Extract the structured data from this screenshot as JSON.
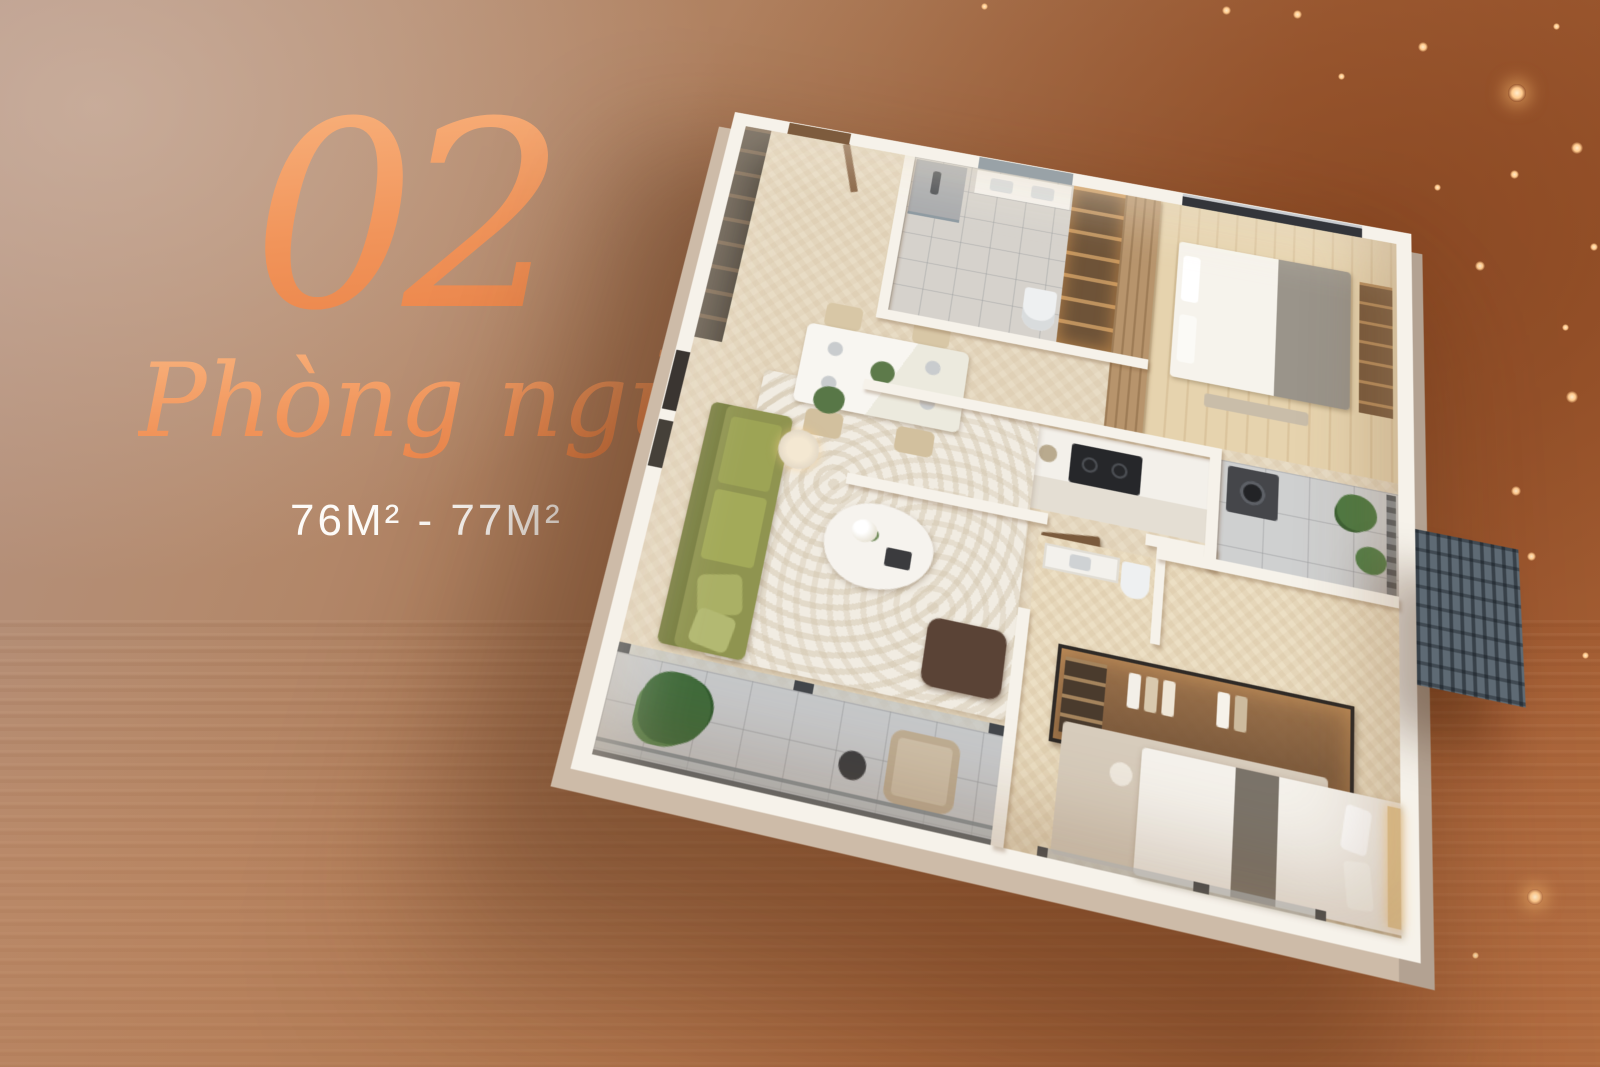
{
  "hero": {
    "unit_number": "02",
    "unit_label": "Phòng ngủ",
    "area_range": "76M² - 77M²"
  },
  "palette": {
    "accent_orange_light": "#F8B27D",
    "accent_orange": "#F2955B",
    "accent_orange_deep": "#EA8145",
    "area_text": "#FDFBF8",
    "bg_taupe": "#B49382",
    "bg_copper": "#A35D33",
    "bg_copper_light": "#BE7D52",
    "wall_white": "#F6F2EA",
    "floor_beige": "#E8DCC5",
    "sparkle_gold": "#FFCA8D",
    "sofa_olive": "#8F9450",
    "closet_bronze": "#7A5437"
  },
  "floorplan": {
    "type": "3d-isometric-cutaway-render",
    "bedrooms_count": 2,
    "rooms": [
      {
        "name": "entry-hall",
        "features": [
          "entry-door",
          "built-in-cabinet"
        ]
      },
      {
        "name": "bathroom",
        "features": [
          "shower",
          "vanity-sink",
          "toilet",
          "mirror"
        ]
      },
      {
        "name": "linen-niche",
        "features": [
          "lit-shelves"
        ]
      },
      {
        "name": "bedroom-2",
        "features": [
          "double-bed",
          "wood-feature-wall",
          "wardrobe",
          "window"
        ]
      },
      {
        "name": "kitchen",
        "features": [
          "refrigerator",
          "double-sink",
          "cooktop",
          "cabinets"
        ]
      },
      {
        "name": "utility-balcony",
        "features": [
          "washing-machine",
          "plants",
          "railing"
        ]
      },
      {
        "name": "ac-ledge",
        "features": [
          "louver-grate"
        ]
      },
      {
        "name": "living-dining",
        "features": [
          "dining-table",
          "four-chairs",
          "olive-sofa",
          "coffee-table",
          "ottoman",
          "floor-lamp",
          "swirl-rug",
          "wall-art"
        ]
      },
      {
        "name": "corridor",
        "features": [
          "door-leaf",
          "door-leaf"
        ]
      },
      {
        "name": "ensuite-wc",
        "features": [
          "vanity",
          "toilet"
        ]
      },
      {
        "name": "walk-in-closet",
        "features": [
          "glass-front",
          "hanging-clothes"
        ]
      },
      {
        "name": "master-bedroom",
        "features": [
          "double-bed",
          "rug",
          "window-wall"
        ]
      },
      {
        "name": "main-balcony",
        "features": [
          "glass-railing",
          "potted-plant",
          "armchair",
          "side-table"
        ]
      }
    ]
  }
}
